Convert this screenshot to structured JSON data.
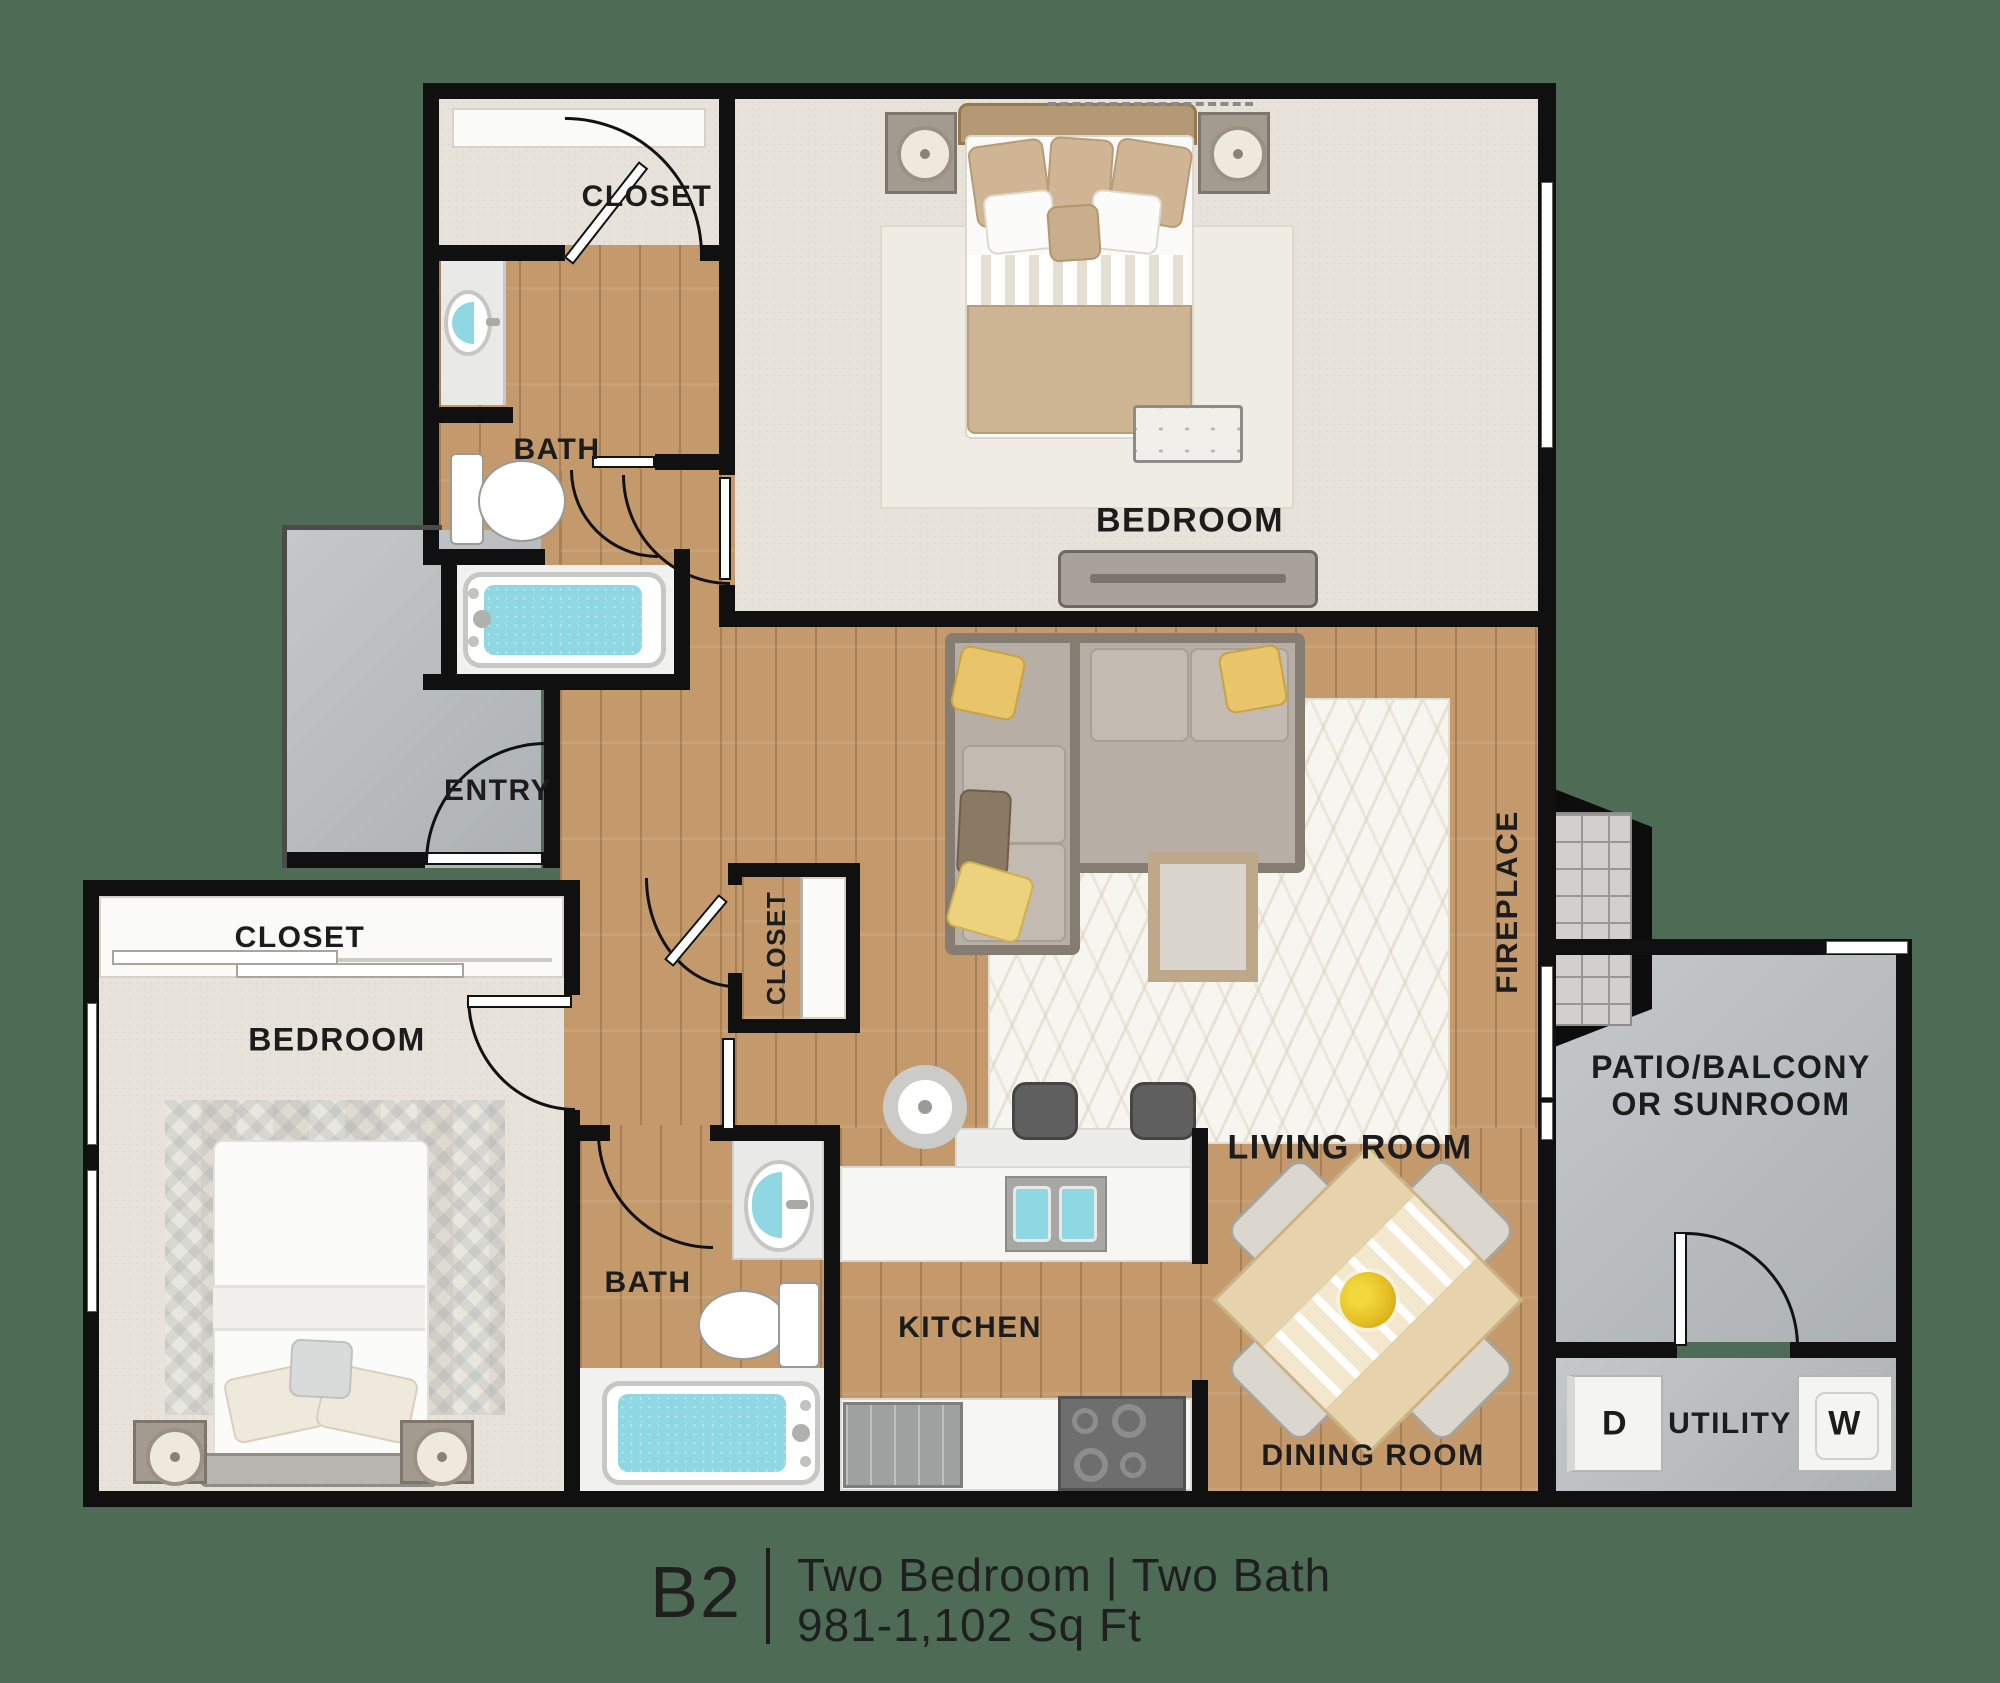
{
  "unit": {
    "code": "B2",
    "summary": "Two Bedroom | Two Bath",
    "sqft": "981-1,102 Sq Ft"
  },
  "rooms": {
    "closet_top": "CLOSET",
    "bath_top": "BATH",
    "bedroom_top": "BEDROOM",
    "entry": "ENTRY",
    "closet_hall": "CLOSET",
    "closet_left": "CLOSET",
    "bedroom_left": "BEDROOM",
    "bath_lower": "BATH",
    "kitchen": "KITCHEN",
    "living": "LIVING ROOM",
    "dining": "DINING ROOM",
    "fireplace": "FIREPLACE",
    "patio": {
      "line1": "PATIO/BALCONY",
      "line2": "OR SUNROOM"
    },
    "utility": "UTILITY",
    "dryer": "D",
    "washer": "W"
  },
  "palette": {
    "background": "#4e6b55",
    "wall": "#101010",
    "wood_floor": "#c49a6c",
    "carpet": "#e8e3da",
    "concrete": "#b7bcbf",
    "water": "#8ed7e3",
    "label_text": "#1c1c1c",
    "accent_pillow": "#e8c46a"
  }
}
